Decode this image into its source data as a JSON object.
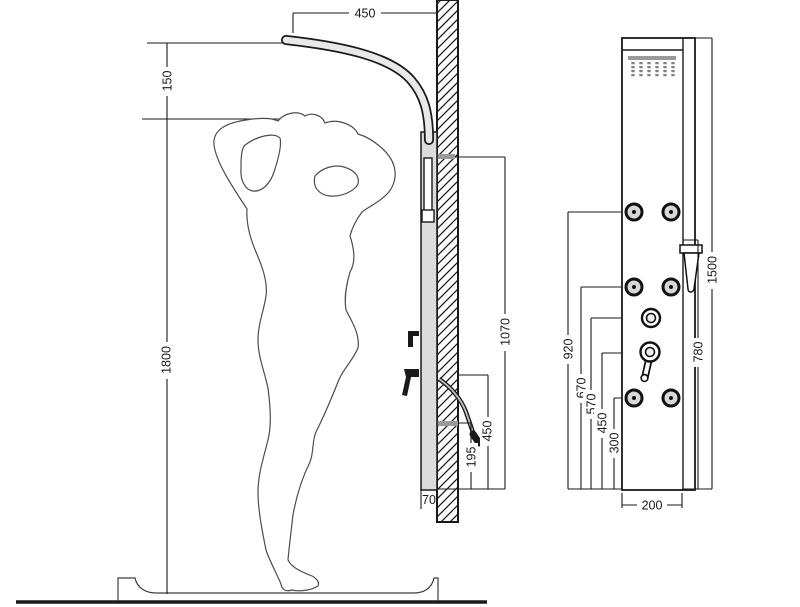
{
  "side_view": {
    "dims": {
      "arm_projection": "450",
      "arm_above_head": "150",
      "figure_height": "1800",
      "rail_height": "1070",
      "hose_outlet_height": "450",
      "hose_loop_height": "195",
      "panel_depth": "70"
    }
  },
  "front_view": {
    "dims": {
      "panel_height": "1500",
      "hand_shower_height": "780",
      "top_jets_height": "920",
      "middle_jets_height": "670",
      "diverter_height": "570",
      "mixer_height": "450",
      "bottom_jets_height": "300",
      "panel_width": "200"
    }
  },
  "colors": {
    "line": "#1a1a1a",
    "panel_fill": "#dcdcdc",
    "bar_gray": "#9a9a9a"
  }
}
